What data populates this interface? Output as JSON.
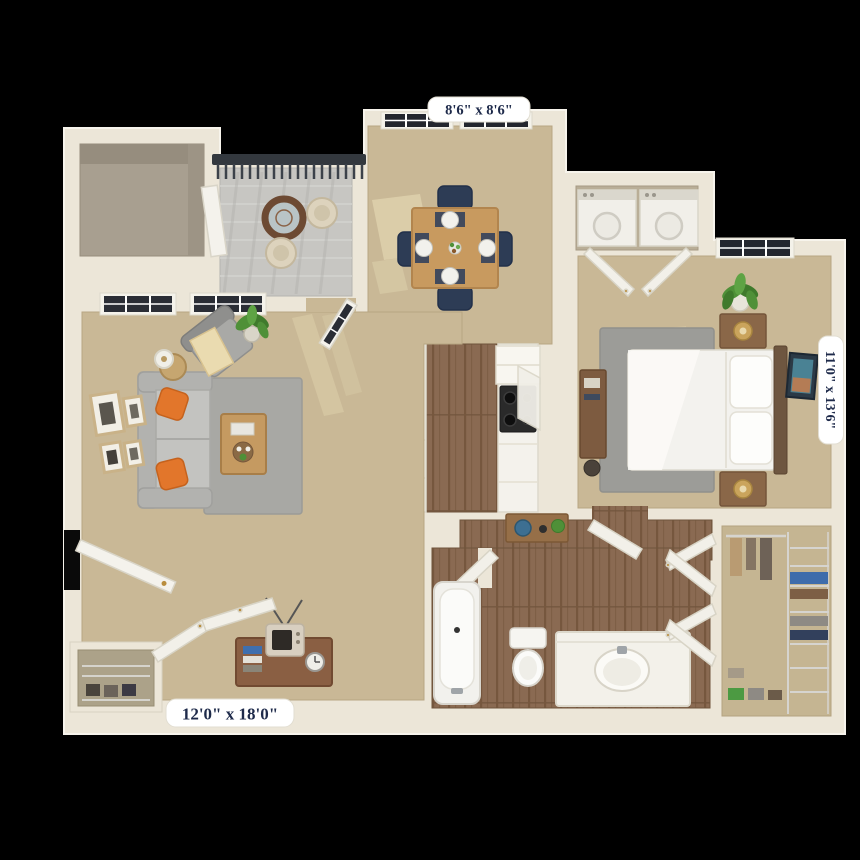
{
  "title": "Apartment 3D Floor Plan",
  "background": "#000000",
  "labels": {
    "dining_room_dimensions": "8'6\" x 8'6\"",
    "bedroom_dimensions": "11'0\" x 13'6\"",
    "living_room_dimensions": "12'0\" x 18'0\""
  },
  "rooms": [
    "balcony",
    "storage-room",
    "dining-room",
    "kitchen",
    "laundry-closet",
    "bedroom",
    "living-room",
    "bathroom",
    "walk-in-closet",
    "entry-closet"
  ],
  "palette": {
    "wall": "#ece6d8",
    "carpet": "#c9b896",
    "wood_floor": "#8a6a52",
    "balcony_floor": "#c7c6c2",
    "railing": "#33383e",
    "rug_gray": "#a8a8a4",
    "sofa_gray": "#c3c3c0",
    "accent_pillow_orange": "#e2762b",
    "navy_chair": "#2d3c55",
    "counter_white": "#f4f2ec",
    "nightstand_brown": "#8a6748",
    "label_text_navy": "#1e2a4a",
    "label_background": "#ffffff"
  }
}
